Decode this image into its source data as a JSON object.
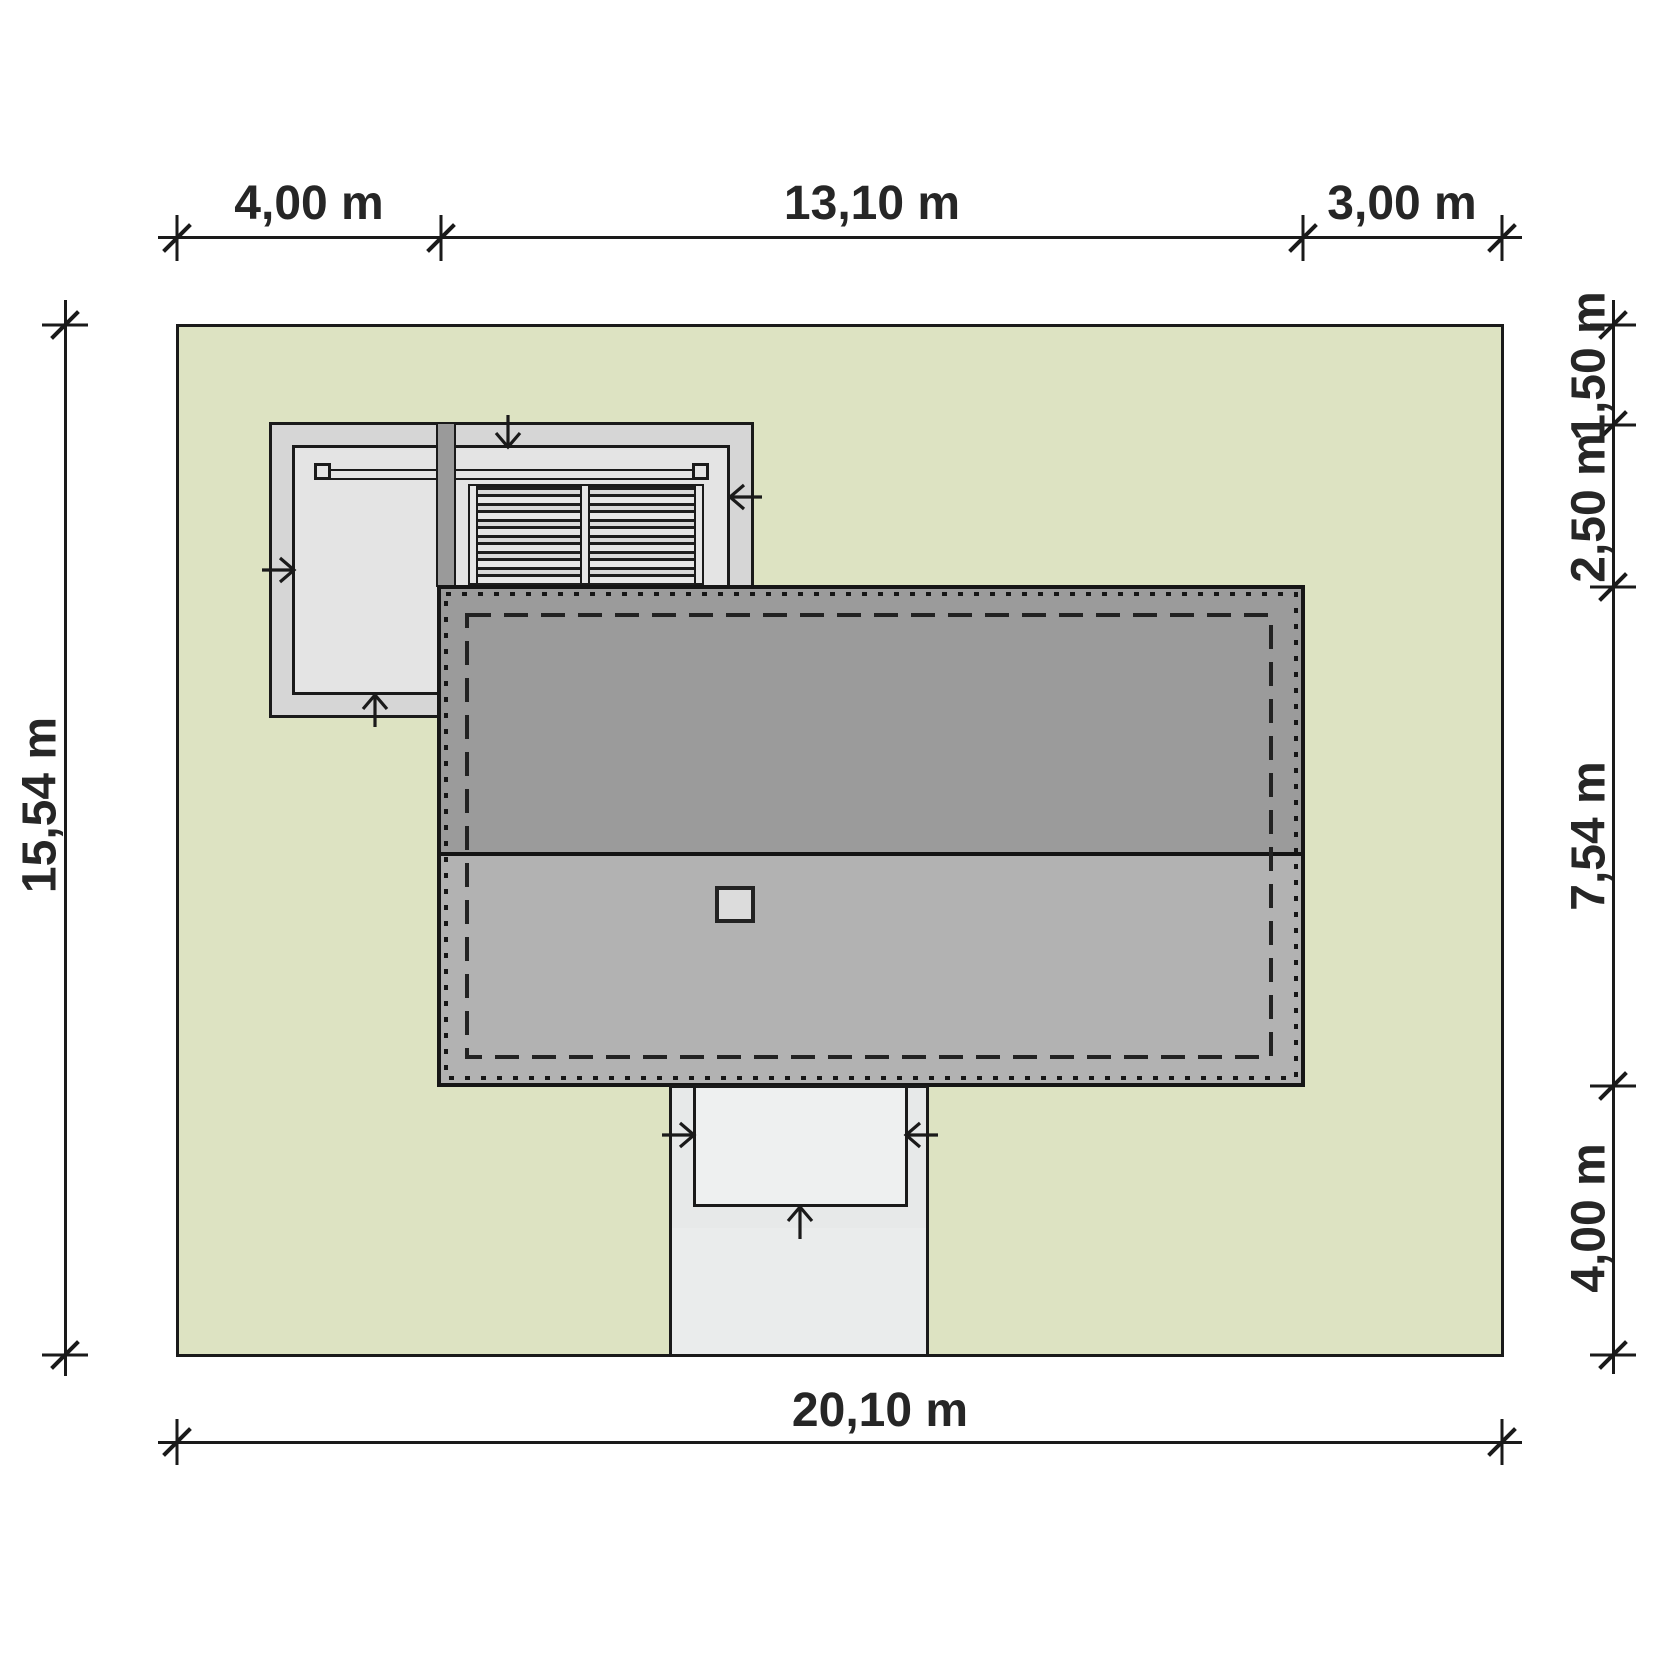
{
  "title": "house site plan",
  "dimensions": {
    "top": [
      "4,00 m",
      "13,10 m",
      "3,00 m"
    ],
    "bottom": [
      "20,10 m"
    ],
    "left": [
      "15,54 m"
    ],
    "right": [
      "1,50 m",
      "2,50 m",
      "7,54 m",
      "4,00 m"
    ]
  },
  "colors": {
    "plot_green": "#dde3c2",
    "roof_upper_slope": "#9b9b9b",
    "roof_lower_slope": "#b2b2b2",
    "terrace_gray": "#d6d6d6",
    "terrace_inner_gray": "#e4e4e4",
    "porch_gray": "#e7e9e9",
    "line": "#1a1a1a",
    "background": "#ffffff"
  }
}
